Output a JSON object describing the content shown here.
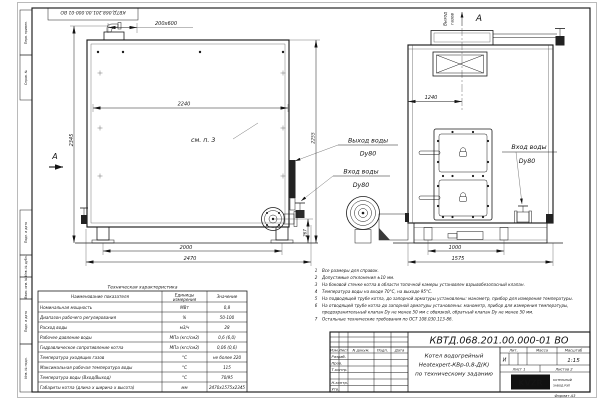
{
  "colors": {
    "brand": "#8c5a28",
    "line": "#1b1b1b"
  },
  "sheet": {
    "corner_doc": "КВТД.068.201.00.000-01 ВО",
    "format_label": "Формат А3",
    "margins": {
      "m1": "Перв. примен.",
      "m2": "Справ. №",
      "m3": "Подп. и дата",
      "m4": "Инв. № дубл.",
      "m5": "Взам. инв. №",
      "m6": "Подп. и дата",
      "m7": "Инв. № подл."
    }
  },
  "side": {
    "dim_nozzle": "200х600",
    "dim_top": "2240",
    "dim_h": "2345",
    "see_note": "см. п. 3",
    "view_arrow": "А",
    "dim_h2": "2255",
    "dim_flange": "267",
    "dim_base": "2000",
    "dim_len": "2470"
  },
  "front": {
    "gas1": "Выход",
    "gas2": "газов",
    "view_label": "А",
    "dim_center": "1240",
    "dim_base": "1000",
    "dim_width": "1575",
    "in1": "Вход воды",
    "in2": "Dу80"
  },
  "labels": {
    "out1": "Выход воды",
    "out2": "Dу80",
    "in1": "Вход воды",
    "in2": "Dу80"
  },
  "notes": [
    {
      "n": "1",
      "t": "Все размеры для справок."
    },
    {
      "n": "2",
      "t": "Допустимые отклонения ±10 мм."
    },
    {
      "n": "3",
      "t": "На боковой стенке котла в области топочной камеры установлен взрывобезопасный клапан."
    },
    {
      "n": "4",
      "t": "Температура воды на входе 70°С, на выходе 95°С."
    },
    {
      "n": "5",
      "t": "На подводящей трубе котла, до запорной арматуры установлены: манометр, прибор для измерения температуры."
    },
    {
      "n": "6",
      "t": "На отводящей трубе котла до запорной арматуры установлены: манометр, прибор для измерения температуры,"
    },
    {
      "n": "",
      "t": "предохранительный клапан Dу не менее 50 мм с обвязкой, обратный клапан Dу не менее 50 мм."
    },
    {
      "n": "7",
      "t": "Остальные технические требования по ОСТ 108.030.113-86."
    }
  ],
  "spec": {
    "title": "Техническая характеристика",
    "h_name": "Наименование показателя",
    "h_u1": "Единицы",
    "h_u2": "измерения",
    "h_val": "Значение",
    "rows": [
      {
        "n": "Номинальная мощность",
        "u": "МВт",
        "v": "0,8"
      },
      {
        "n": "Диапазон рабочего регулирования",
        "u": "%",
        "v": "50-100"
      },
      {
        "n": "Расход воды",
        "u": "м3/ч",
        "v": "28"
      },
      {
        "n": "Рабочее давление воды",
        "u": "МПа (кгс/см2)",
        "v": "0,6 (6,0)"
      },
      {
        "n": "Гидравлическое сопротивление котла",
        "u": "МПа (кгс/см2)",
        "v": "0,06 (0,6)"
      },
      {
        "n": "Температура уходящих газов",
        "u": "°С",
        "v": "не более 220"
      },
      {
        "n": "Максимальная рабочая температура воды",
        "u": "°С",
        "v": "115"
      },
      {
        "n": "Температура воды (Вход/Выход)",
        "u": "°С",
        "v": "70/95"
      },
      {
        "n": "Габариты котла (длина х ширина х высота)",
        "u": "мм",
        "v": "2470х1575х2345"
      }
    ]
  },
  "tb": {
    "doc": "КВТД.068.201.00.000-01 ВО",
    "izm": "Изм.",
    "list": "Лист",
    "ndoc": "N докум.",
    "podp": "Подп.",
    "data": "Дата",
    "razrab": "Разраб.",
    "prov": "Пров.",
    "tkontr": "Т.контр.",
    "nkontr": "Н.контр.",
    "utv": "Утв.",
    "name1": "Котел водогрейный",
    "name2": "Heatexpert-КВр-0,8-Д(К)",
    "name3": "по техническому заданию",
    "lit": "Лит.",
    "massa": "Масса",
    "mash": "Масштаб",
    "lit_v": "И",
    "scale": "1:15",
    "sheet": "Лист 1",
    "sheets": "Листов 2",
    "logo": "KVZR",
    "logo1": "КОТЕЛЬНЫЙ",
    "logo2": "ЗАВОД РЭП"
  }
}
